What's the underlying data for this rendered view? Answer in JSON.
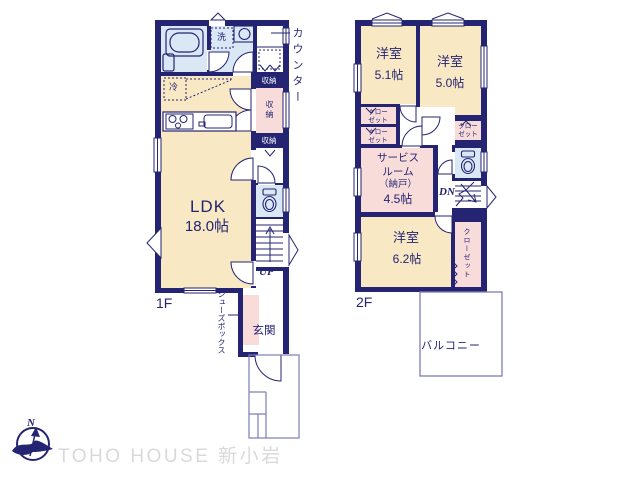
{
  "colors": {
    "wall_navy": "#242473",
    "room_cream": "#f8e8c3",
    "room_pink": "#f8dcd9",
    "room_blue": "#dae7f5",
    "outline_light": "#7d7db8",
    "watermark_gray": "#d9d9d9"
  },
  "floor1": {
    "floor_label": "1F",
    "ldk_name": "LDK",
    "ldk_size": "18.0帖",
    "counter_label": "カウンター",
    "laundry_label": "洗",
    "fridge_label": "冷",
    "storage_top_label": "収納",
    "storage_mid_label": "収納",
    "storage_bottom_label": "収納",
    "stairs_up_label": "UP",
    "shoebox_label": "シューズボックス",
    "entrance_label": "玄関"
  },
  "floor2": {
    "floor_label": "2F",
    "bedroom1_name": "洋室",
    "bedroom1_size": "5.1帖",
    "bedroom2_name": "洋室",
    "bedroom2_size": "5.0帖",
    "bedroom3_name": "洋室",
    "bedroom3_size": "6.2帖",
    "closet_line1": "クロー",
    "closet_line2": "ゼット",
    "closet_vertical_label": "クローゼット",
    "service_room_line1": "サービス",
    "service_room_line2": "ルーム",
    "service_room_line3": "（納戸）",
    "service_room_size": "4.5帖",
    "stairs_down_label": "DN",
    "balcony_label": "バルコニー"
  },
  "branding": {
    "watermark": "TOHO HOUSE 新小岩",
    "compass_north_label": "N"
  }
}
